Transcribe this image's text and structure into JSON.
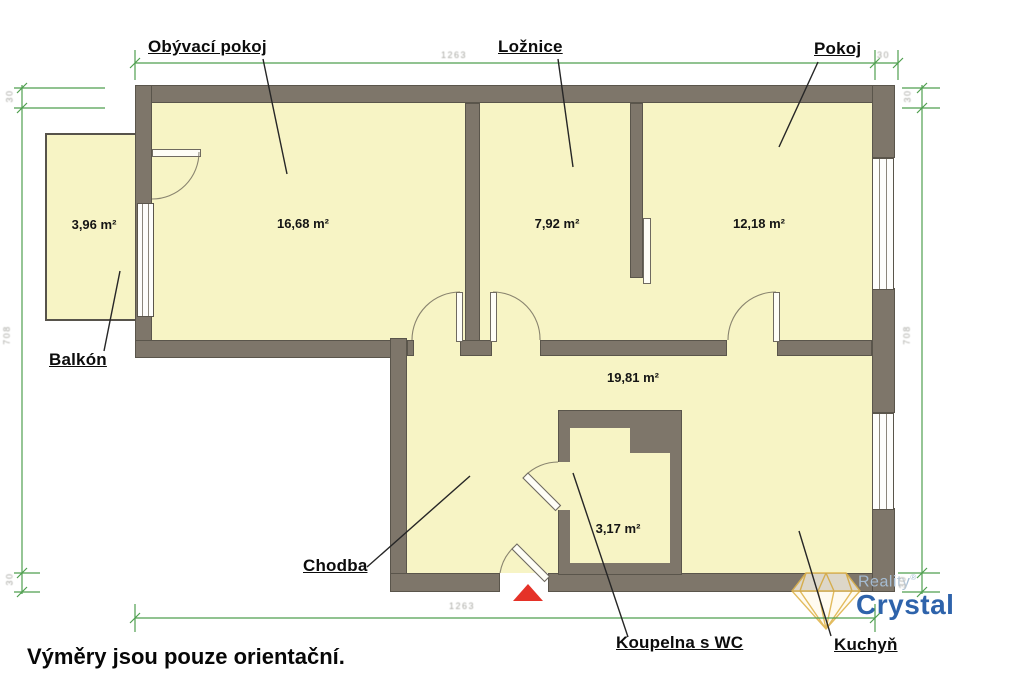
{
  "plan": {
    "rooms": [
      {
        "label": "Obývací pokoj",
        "area": "16,68 m²"
      },
      {
        "label": "Ložnice",
        "area": "7,92 m²"
      },
      {
        "label": "Pokoj",
        "area": "12,18 m²"
      },
      {
        "label": "Balkón",
        "area": "3,96 m²"
      },
      {
        "label": "Chodba",
        "area": "19,81 m²"
      },
      {
        "label": "Koupelna s WC",
        "area": "3,17 m²"
      },
      {
        "label": "Kuchyň",
        "area": ""
      }
    ],
    "dimensions": {
      "top_width": "1263",
      "bottom_width": "1263",
      "top_right_wall": "30",
      "left": {
        "top_wall": "30",
        "height": "708",
        "bottom_wall": "30"
      },
      "right": {
        "top_wall": "30",
        "height": "708",
        "bottom_wall": "30"
      }
    },
    "note": "Výměry jsou pouze orientační."
  },
  "logo": {
    "line1": "Reality",
    "reg": "®",
    "line2": "Crystal"
  },
  "colors": {
    "room_fill": "#f7f4c5",
    "wall": "#7e766a",
    "dimension_green": "#4f9f4f",
    "logo_blue": "#2e63ab",
    "logo_light_blue": "#a5bcd2",
    "diamond_gold": "#dfb44c",
    "entrance_red": "#e53228"
  }
}
